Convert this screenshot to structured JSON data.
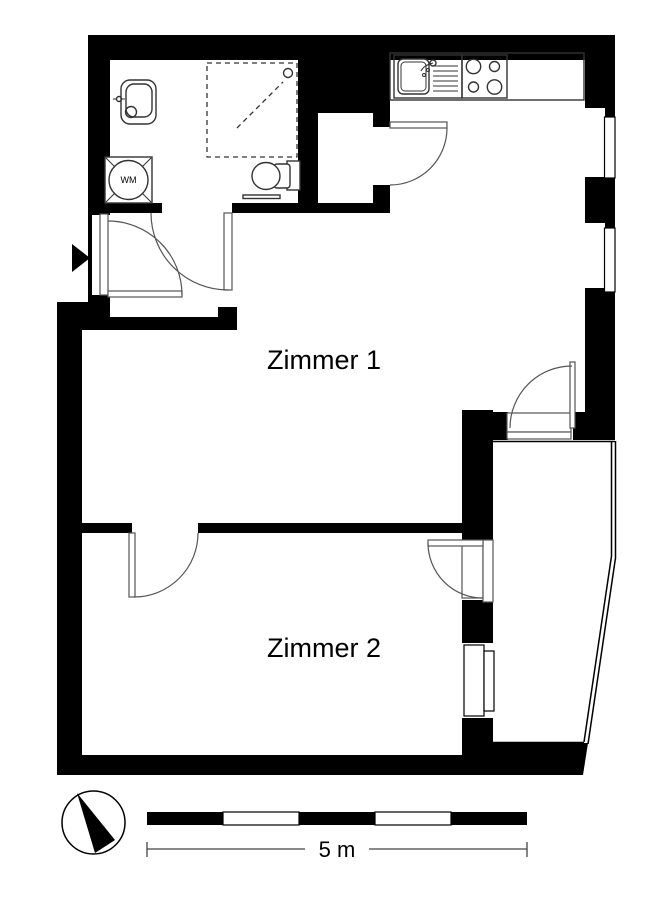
{
  "floorplan": {
    "type": "apartment-floor-plan",
    "rooms": [
      {
        "name": "zimmer-1",
        "label": "Zimmer 1"
      },
      {
        "name": "zimmer-2",
        "label": "Zimmer 2"
      },
      {
        "name": "bathroom",
        "label": ""
      },
      {
        "name": "kitchen",
        "label": ""
      },
      {
        "name": "balcony",
        "label": ""
      }
    ],
    "appliances": {
      "washing_machine_label": "WM"
    },
    "scale_bar": {
      "label": "5 m",
      "segments": 5
    },
    "colors": {
      "walls": "#000000",
      "background": "#ffffff",
      "fixture_lines": "#333333",
      "door_arcs": "#555555",
      "dimension_line": "#444444"
    },
    "icons": [
      "north-arrow-icon",
      "entrance-arrow-icon",
      "shower-icon",
      "toilet-icon",
      "bathroom-sink-icon",
      "washing-machine-icon",
      "kitchen-sink-icon",
      "stove-icon"
    ]
  }
}
